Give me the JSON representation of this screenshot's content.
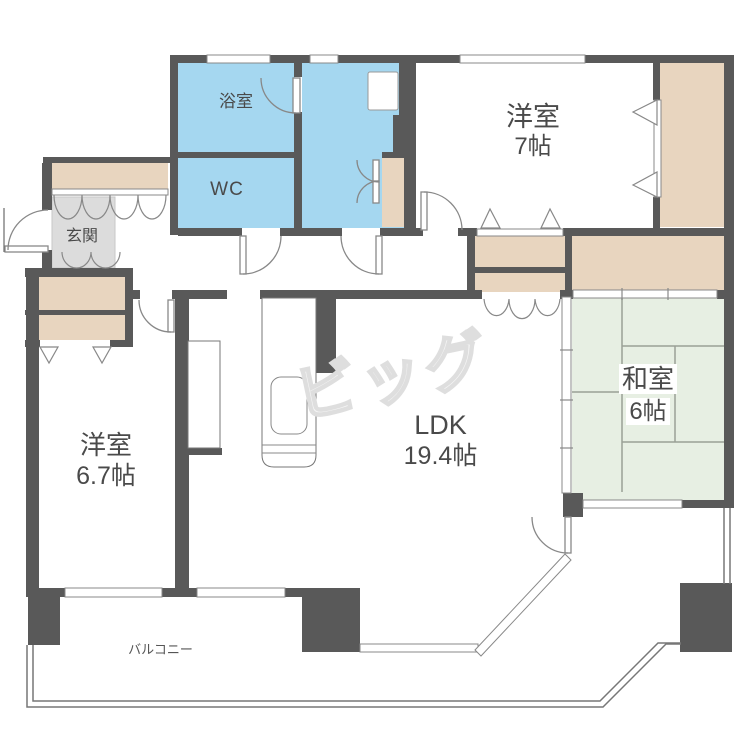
{
  "plan": {
    "title": "apartment-floor-plan",
    "watermark": "ビッグ",
    "rooms": {
      "bath": {
        "label": "浴室"
      },
      "wc": {
        "label": "WC"
      },
      "entrance": {
        "label": "玄関"
      },
      "western_room_7": {
        "label": "洋室",
        "size": "7帖"
      },
      "western_room_67": {
        "label": "洋室",
        "size": "6.7帖"
      },
      "ldk": {
        "label": "LDK",
        "size": "19.4帖"
      },
      "japanese_room": {
        "label": "和室",
        "size": "6帖"
      },
      "balcony": {
        "label": "バルコニー"
      }
    },
    "colors": {
      "wall": "#595959",
      "water_rooms": "#a5d7f0",
      "closets": "#e8d5bf",
      "tatami": "#e7efe3",
      "entrance_floor": "#dcdcdc",
      "line": "#888888"
    }
  }
}
